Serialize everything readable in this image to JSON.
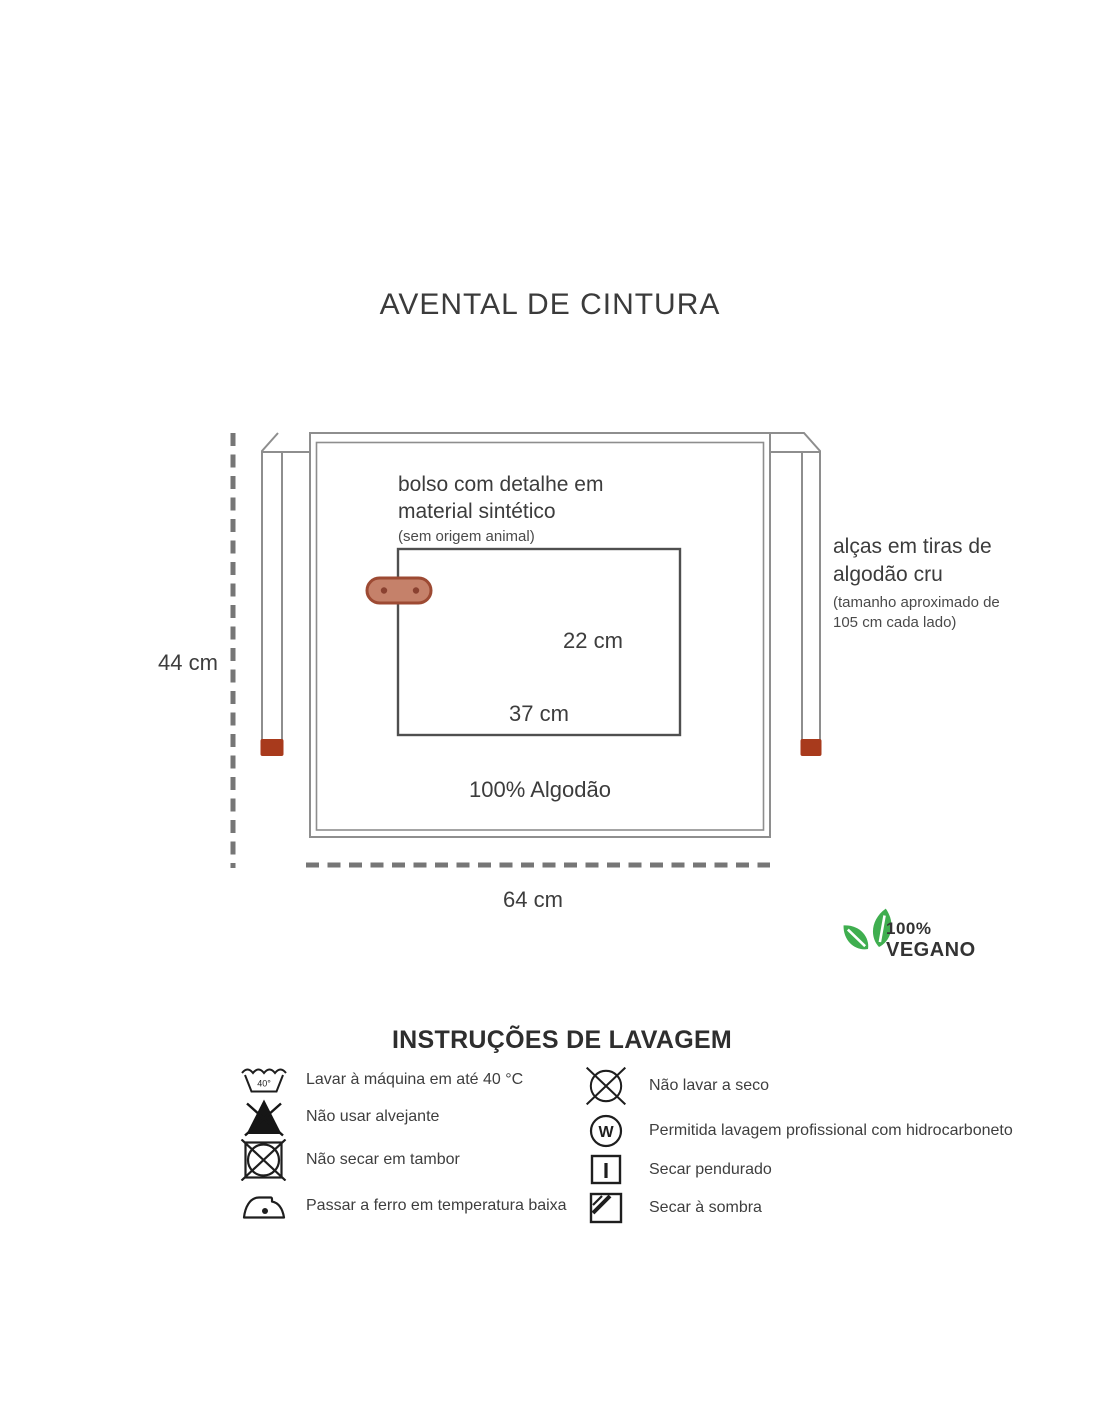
{
  "page": {
    "title": "AVENTAL DE CINTURA"
  },
  "apron": {
    "pocket_label_line1": "bolso com detalhe em",
    "pocket_label_line2": "material sintético",
    "pocket_note": "(sem origem animal)",
    "straps_label_line1": "alças em tiras de",
    "straps_label_line2": "algodão cru",
    "straps_note_line1": "(tamanho aproximado de",
    "straps_note_line2": "105 cm cada lado)",
    "material": "100% Algodão",
    "dim_height": "44 cm",
    "dim_pocket_height": "22 cm",
    "dim_pocket_width": "37 cm",
    "dim_width": "64 cm"
  },
  "vegan_badge": {
    "line1": "100%",
    "line2": "VEGANO"
  },
  "wash": {
    "title": "INSTRUÇÕES DE LAVAGEM",
    "temp_label": "40°",
    "w_label": "W",
    "left": [
      {
        "icon": "machine-wash-40-icon",
        "label": "Lavar à máquina em até 40 °C"
      },
      {
        "icon": "do-not-bleach-icon",
        "label": "Não usar alvejante"
      },
      {
        "icon": "do-not-tumble-dry-icon",
        "label": "Não secar em tambor"
      },
      {
        "icon": "iron-low-temperature-icon",
        "label": "Passar a ferro em temperatura baixa"
      }
    ],
    "right": [
      {
        "icon": "do-not-dry-clean-icon",
        "label": "Não lavar a seco"
      },
      {
        "icon": "professional-wet-clean-icon",
        "label": "Permitida lavagem profissional com hidrocarboneto"
      },
      {
        "icon": "hang-dry-icon",
        "label": "Secar pendurado"
      },
      {
        "icon": "dry-in-shade-icon",
        "label": "Secar à sombra"
      }
    ]
  },
  "colors": {
    "outline_gray": "#8e8e8e",
    "pocket_line": "#4f4f4f",
    "accent_red": "#a83a1c",
    "tab_fill": "#c5816a",
    "tab_border": "#9d4a33",
    "leaf_green": "#3fae4f",
    "text_dark": "#3b3b3b"
  }
}
